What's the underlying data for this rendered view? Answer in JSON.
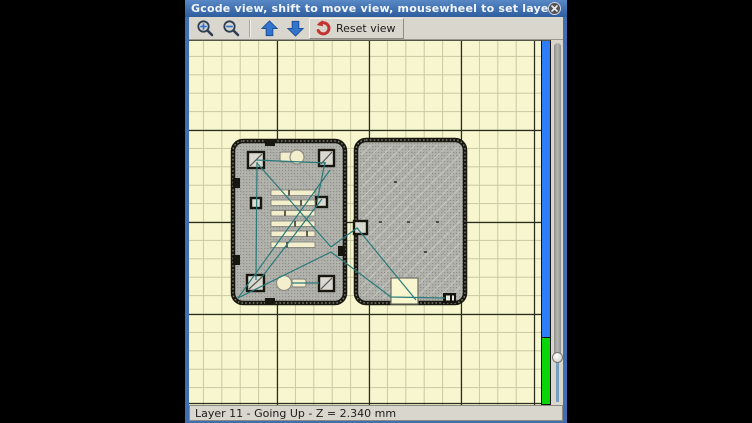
{
  "window": {
    "title": "Gcode view, shift to move view, mousewheel to set layer"
  },
  "toolbar": {
    "reset_label": "Reset view",
    "buttons": [
      {
        "name": "zoom-in",
        "icon": "magnifier-plus-icon"
      },
      {
        "name": "zoom-out",
        "icon": "magnifier-minus-icon"
      },
      {
        "name": "layer-up",
        "icon": "blue-arrow-up-icon"
      },
      {
        "name": "layer-down",
        "icon": "blue-arrow-down-icon"
      },
      {
        "name": "reset-view",
        "icon": "red-undo-arrow-icon",
        "label": "Reset view"
      }
    ]
  },
  "icons": {
    "close": "circle-x-icon"
  },
  "status_bar": {
    "text": "Layer 11 - Going Up - Z = 2.340 mm",
    "layer": "11",
    "direction": "Going Up",
    "z": "2.340 mm"
  },
  "viewer": {
    "layer_progress_bar": {
      "remaining_color": "#2e7dfb",
      "done_color": "#09d509",
      "done_fraction": "0.18"
    },
    "slider_thumb_position_fraction": "0.77",
    "objects": [
      "left-plate-with-slots-and-corner-holes",
      "right-plate-with-bottom-notch"
    ],
    "travel_move_color": "#2a7a7a"
  },
  "colors": {
    "title_top": "#5988c6",
    "title_bottom": "#2e5d9e",
    "window_border": "#3f6fb2",
    "toolbar_bg": "#d9d6ce",
    "canvas_bg": "#f7f6cf",
    "grid_minor": "#c9c9a2",
    "grid_major": "#2b2b20",
    "object_fill": "#b3b3ae",
    "travel": "#2a7a7a",
    "layer_blue": "#2e7dfb",
    "layer_green": "#09d509",
    "accent_red": "#c23430",
    "arrow_blue": "#3374cf"
  }
}
